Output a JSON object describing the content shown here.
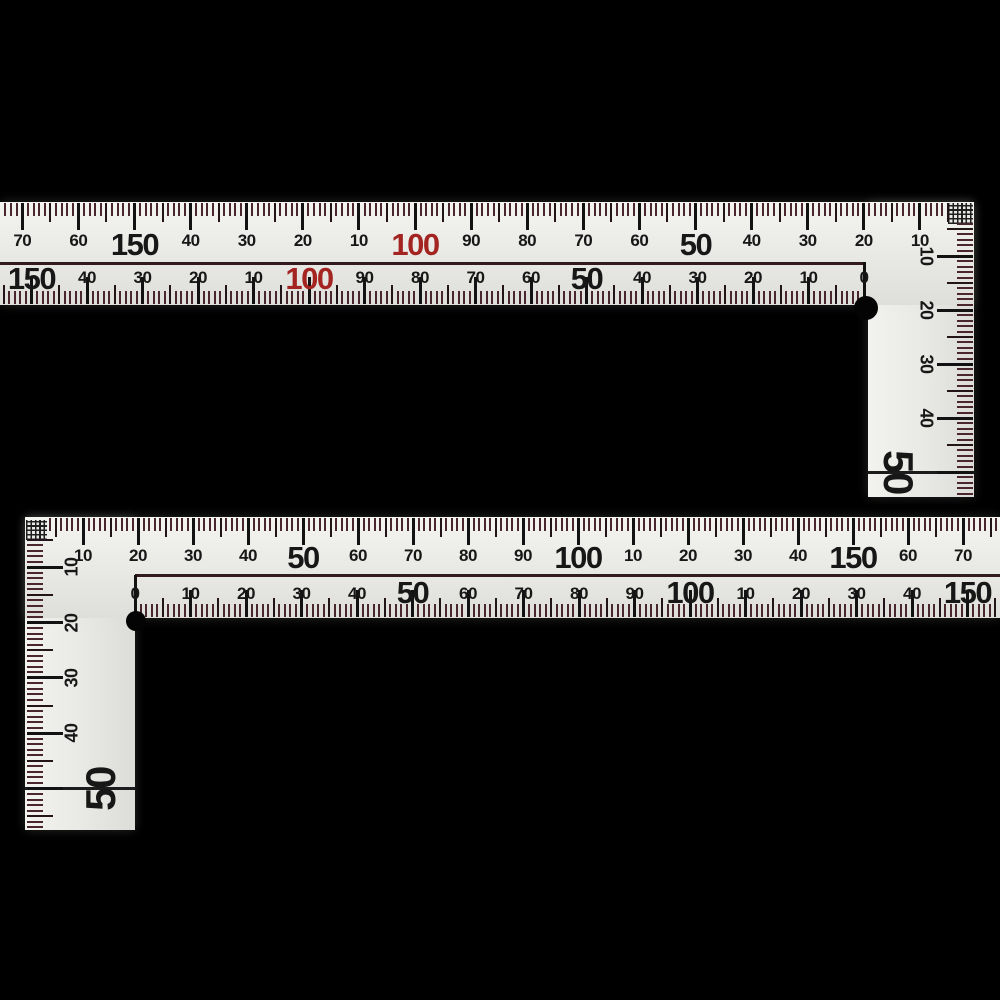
{
  "scene": {
    "description": "Two L-shaped metric carpenter framing squares on a black background"
  },
  "colors": {
    "background": "#000000",
    "body": "#eaeae7",
    "tick_major": "#121212",
    "tick_mid": "#221418",
    "tick_minor": "#4a272f",
    "label": "#171717",
    "red_label": "#a32421",
    "separator": "#331a1e"
  },
  "rulers": [
    {
      "name": "top-framing-square",
      "blade": {
        "x": 0,
        "y": 202,
        "w": 974,
        "h": 103
      },
      "arm": {
        "x": 868,
        "y": 202,
        "w": 106,
        "h": 295
      },
      "crosshatch": {
        "x": 948,
        "y": 203,
        "w": 25,
        "h": 21
      },
      "separator": {
        "x": 0,
        "y": 262,
        "w": 866,
        "h": 2.5
      },
      "fifty_line": {
        "x": 868,
        "y": 471,
        "w": 106,
        "h": 2.5
      },
      "hole": {
        "cx": 866,
        "cy": 308,
        "r": 12
      },
      "scales": [
        {
          "id": "outer-top-scale",
          "axis": "x",
          "edge": 203,
          "tick_dir": 1,
          "origin": 976,
          "sign": -1,
          "ppu": 5.61,
          "vmin": 5,
          "vmax": 173,
          "label_at": 241,
          "big_at": 245,
          "rot": 0,
          "len": {
            "minor": 13,
            "mid": 19,
            "major": 27
          },
          "labels": [
            {
              "v": 10,
              "t": "10"
            },
            {
              "v": 20,
              "t": "20"
            },
            {
              "v": 30,
              "t": "30"
            },
            {
              "v": 40,
              "t": "40"
            },
            {
              "v": 50,
              "t": "50",
              "big": true
            },
            {
              "v": 60,
              "t": "60"
            },
            {
              "v": 70,
              "t": "70"
            },
            {
              "v": 80,
              "t": "80"
            },
            {
              "v": 90,
              "t": "90"
            },
            {
              "v": 100,
              "t": "100",
              "big": true,
              "red": true
            },
            {
              "v": 110,
              "t": "10"
            },
            {
              "v": 120,
              "t": "20"
            },
            {
              "v": 130,
              "t": "30"
            },
            {
              "v": 140,
              "t": "40"
            },
            {
              "v": 150,
              "t": "150",
              "big": true
            },
            {
              "v": 160,
              "t": "60"
            },
            {
              "v": 170,
              "t": "70"
            }
          ]
        },
        {
          "id": "inner-bottom-scale",
          "axis": "x",
          "edge": 304,
          "tick_dir": -1,
          "origin": 864,
          "sign": -1,
          "ppu": 5.55,
          "vmin": 0,
          "vmax": 155,
          "label_at": 278,
          "big_at": 279,
          "rot": 0,
          "len": {
            "minor": 13,
            "mid": 19,
            "major": 27,
            "zero": 42
          },
          "labels": [
            {
              "v": 0,
              "t": "0"
            },
            {
              "v": 10,
              "t": "10"
            },
            {
              "v": 20,
              "t": "20"
            },
            {
              "v": 30,
              "t": "30"
            },
            {
              "v": 40,
              "t": "40"
            },
            {
              "v": 50,
              "t": "50",
              "big": true
            },
            {
              "v": 60,
              "t": "60"
            },
            {
              "v": 70,
              "t": "70"
            },
            {
              "v": 80,
              "t": "80"
            },
            {
              "v": 90,
              "t": "90"
            },
            {
              "v": 100,
              "t": "100",
              "big": true,
              "red": true
            },
            {
              "v": 110,
              "t": "10"
            },
            {
              "v": 120,
              "t": "20"
            },
            {
              "v": 130,
              "t": "30"
            },
            {
              "v": 140,
              "t": "40"
            },
            {
              "v": 150,
              "t": "150",
              "big": true
            }
          ]
        },
        {
          "id": "arm-right-scale",
          "axis": "y",
          "edge": 973,
          "tick_dir": -1,
          "origin": 202,
          "sign": 1,
          "ppu": 5.4,
          "vmin": 4,
          "vmax": 54,
          "label_at": 926,
          "big_at": 898,
          "rot": 90,
          "len": {
            "minor": 16,
            "mid": 26,
            "major": 36
          },
          "labels": [
            {
              "v": 10,
              "t": "10",
              "sz": 18
            },
            {
              "v": 20,
              "t": "20",
              "sz": 18
            },
            {
              "v": 30,
              "t": "30",
              "sz": 18
            },
            {
              "v": 40,
              "t": "40",
              "sz": 18
            },
            {
              "v": 50,
              "t": "50",
              "big": true,
              "sz": 42
            }
          ]
        }
      ]
    },
    {
      "name": "bottom-framing-square",
      "blade": {
        "x": 25,
        "y": 517,
        "w": 975,
        "h": 101
      },
      "arm": {
        "x": 25,
        "y": 517,
        "w": 110,
        "h": 313
      },
      "crosshatch": {
        "x": 26,
        "y": 520,
        "w": 21,
        "h": 20
      },
      "separator": {
        "x": 135,
        "y": 574,
        "w": 865,
        "h": 2.5
      },
      "fifty_line": {
        "x": 25,
        "y": 787,
        "w": 110,
        "h": 2.5
      },
      "hole": {
        "cx": 136,
        "cy": 621,
        "r": 10
      },
      "scales": [
        {
          "id": "outer-top-scale",
          "axis": "x",
          "edge": 518,
          "tick_dir": 1,
          "origin": 28,
          "sign": 1,
          "ppu": 5.5,
          "vmin": 4,
          "vmax": 176,
          "label_at": 556,
          "big_at": 558,
          "rot": 0,
          "len": {
            "minor": 13,
            "mid": 19,
            "major": 27
          },
          "labels": [
            {
              "v": 10,
              "t": "10"
            },
            {
              "v": 20,
              "t": "20"
            },
            {
              "v": 30,
              "t": "30"
            },
            {
              "v": 40,
              "t": "40"
            },
            {
              "v": 50,
              "t": "50",
              "big": true
            },
            {
              "v": 60,
              "t": "60"
            },
            {
              "v": 70,
              "t": "70"
            },
            {
              "v": 80,
              "t": "80"
            },
            {
              "v": 90,
              "t": "90"
            },
            {
              "v": 100,
              "t": "100",
              "big": true
            },
            {
              "v": 110,
              "t": "10"
            },
            {
              "v": 120,
              "t": "20"
            },
            {
              "v": 130,
              "t": "30"
            },
            {
              "v": 140,
              "t": "40"
            },
            {
              "v": 150,
              "t": "150",
              "big": true
            },
            {
              "v": 160,
              "t": "60"
            },
            {
              "v": 170,
              "t": "70"
            }
          ]
        },
        {
          "id": "inner-bottom-scale",
          "axis": "x",
          "edge": 617,
          "tick_dir": -1,
          "origin": 135,
          "sign": 1,
          "ppu": 5.55,
          "vmin": 0,
          "vmax": 155,
          "label_at": 594,
          "big_at": 593,
          "rot": 0,
          "len": {
            "minor": 13,
            "mid": 19,
            "major": 27,
            "zero": 42
          },
          "labels": [
            {
              "v": 0,
              "t": "0"
            },
            {
              "v": 10,
              "t": "10"
            },
            {
              "v": 20,
              "t": "20"
            },
            {
              "v": 30,
              "t": "30"
            },
            {
              "v": 40,
              "t": "40"
            },
            {
              "v": 50,
              "t": "50",
              "big": true
            },
            {
              "v": 60,
              "t": "60"
            },
            {
              "v": 70,
              "t": "70"
            },
            {
              "v": 80,
              "t": "80"
            },
            {
              "v": 90,
              "t": "90"
            },
            {
              "v": 100,
              "t": "100",
              "big": true
            },
            {
              "v": 110,
              "t": "10"
            },
            {
              "v": 120,
              "t": "20"
            },
            {
              "v": 130,
              "t": "30"
            },
            {
              "v": 140,
              "t": "40"
            },
            {
              "v": 150,
              "t": "150",
              "big": true
            }
          ]
        },
        {
          "id": "arm-left-scale",
          "axis": "y",
          "edge": 27,
          "tick_dir": 1,
          "origin": 512,
          "sign": 1,
          "ppu": 5.53,
          "vmin": 5,
          "vmax": 57,
          "label_at": 72,
          "big_at": 101,
          "rot": -90,
          "len": {
            "minor": 16,
            "mid": 26,
            "major": 36
          },
          "labels": [
            {
              "v": 10,
              "t": "10",
              "sz": 18
            },
            {
              "v": 20,
              "t": "20",
              "sz": 18
            },
            {
              "v": 30,
              "t": "30",
              "sz": 18
            },
            {
              "v": 40,
              "t": "40",
              "sz": 18
            },
            {
              "v": 50,
              "t": "50",
              "big": true,
              "sz": 42
            }
          ]
        }
      ]
    }
  ]
}
